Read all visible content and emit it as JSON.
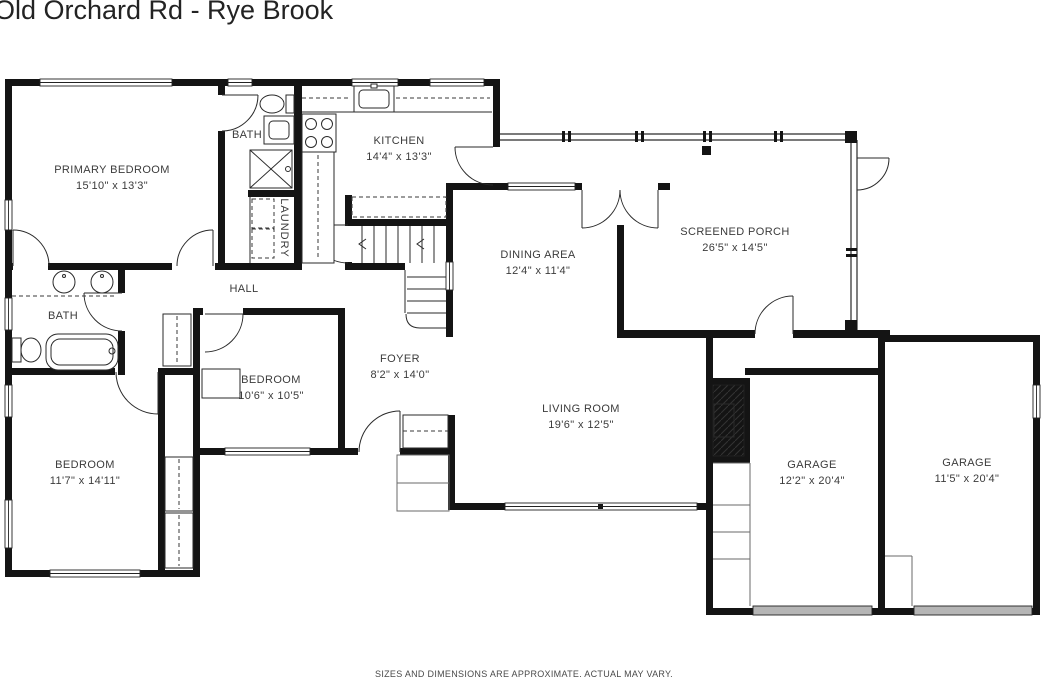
{
  "title": "Old Orchard Rd - Rye Brook",
  "disclaimer": "SIZES AND DIMENSIONS ARE APPROXIMATE. ACTUAL MAY VARY.",
  "colors": {
    "wall": "#141414",
    "garage_door": "#b5b5b5",
    "label_text": "#3b3b3b",
    "title_text": "#232323"
  },
  "rooms": [
    {
      "id": "primary-bedroom",
      "label": "PRIMARY BEDROOM",
      "dims": "15'10\" x 13'3\"",
      "x": 112,
      "y": 179
    },
    {
      "id": "bath-ensuite",
      "label": "BATH",
      "dims": "",
      "x": 247,
      "y": 136
    },
    {
      "id": "kitchen",
      "label": "KITCHEN",
      "dims": "14'4\" x 13'3\"",
      "x": 399,
      "y": 150
    },
    {
      "id": "laundry",
      "label": "LAUNDRY",
      "dims": "",
      "x": 283,
      "y": 228,
      "vertical": true
    },
    {
      "id": "hall",
      "label": "HALL",
      "dims": "",
      "x": 244,
      "y": 290
    },
    {
      "id": "bath-hall",
      "label": "BATH",
      "dims": "",
      "x": 63,
      "y": 317
    },
    {
      "id": "dining-area",
      "label": "DINING AREA",
      "dims": "12'4\" x 11'4\"",
      "x": 538,
      "y": 264
    },
    {
      "id": "screened-porch",
      "label": "SCREENED PORCH",
      "dims": "26'5\" x 14'5\"",
      "x": 735,
      "y": 241
    },
    {
      "id": "foyer",
      "label": "FOYER",
      "dims": "8'2\" x 14'0\"",
      "x": 400,
      "y": 368
    },
    {
      "id": "bedroom-middle",
      "label": "BEDROOM",
      "dims": "10'6\" x 10'5\"",
      "x": 271,
      "y": 389
    },
    {
      "id": "bedroom-corner",
      "label": "BEDROOM",
      "dims": "11'7\" x 14'11\"",
      "x": 85,
      "y": 474
    },
    {
      "id": "living-room",
      "label": "LIVING ROOM",
      "dims": "19'6\" x 12'5\"",
      "x": 581,
      "y": 418
    },
    {
      "id": "garage-left",
      "label": "GARAGE",
      "dims": "12'2\" x 20'4\"",
      "x": 812,
      "y": 474
    },
    {
      "id": "garage-right",
      "label": "GARAGE",
      "dims": "11'5\" x 20'4\"",
      "x": 967,
      "y": 472
    }
  ]
}
